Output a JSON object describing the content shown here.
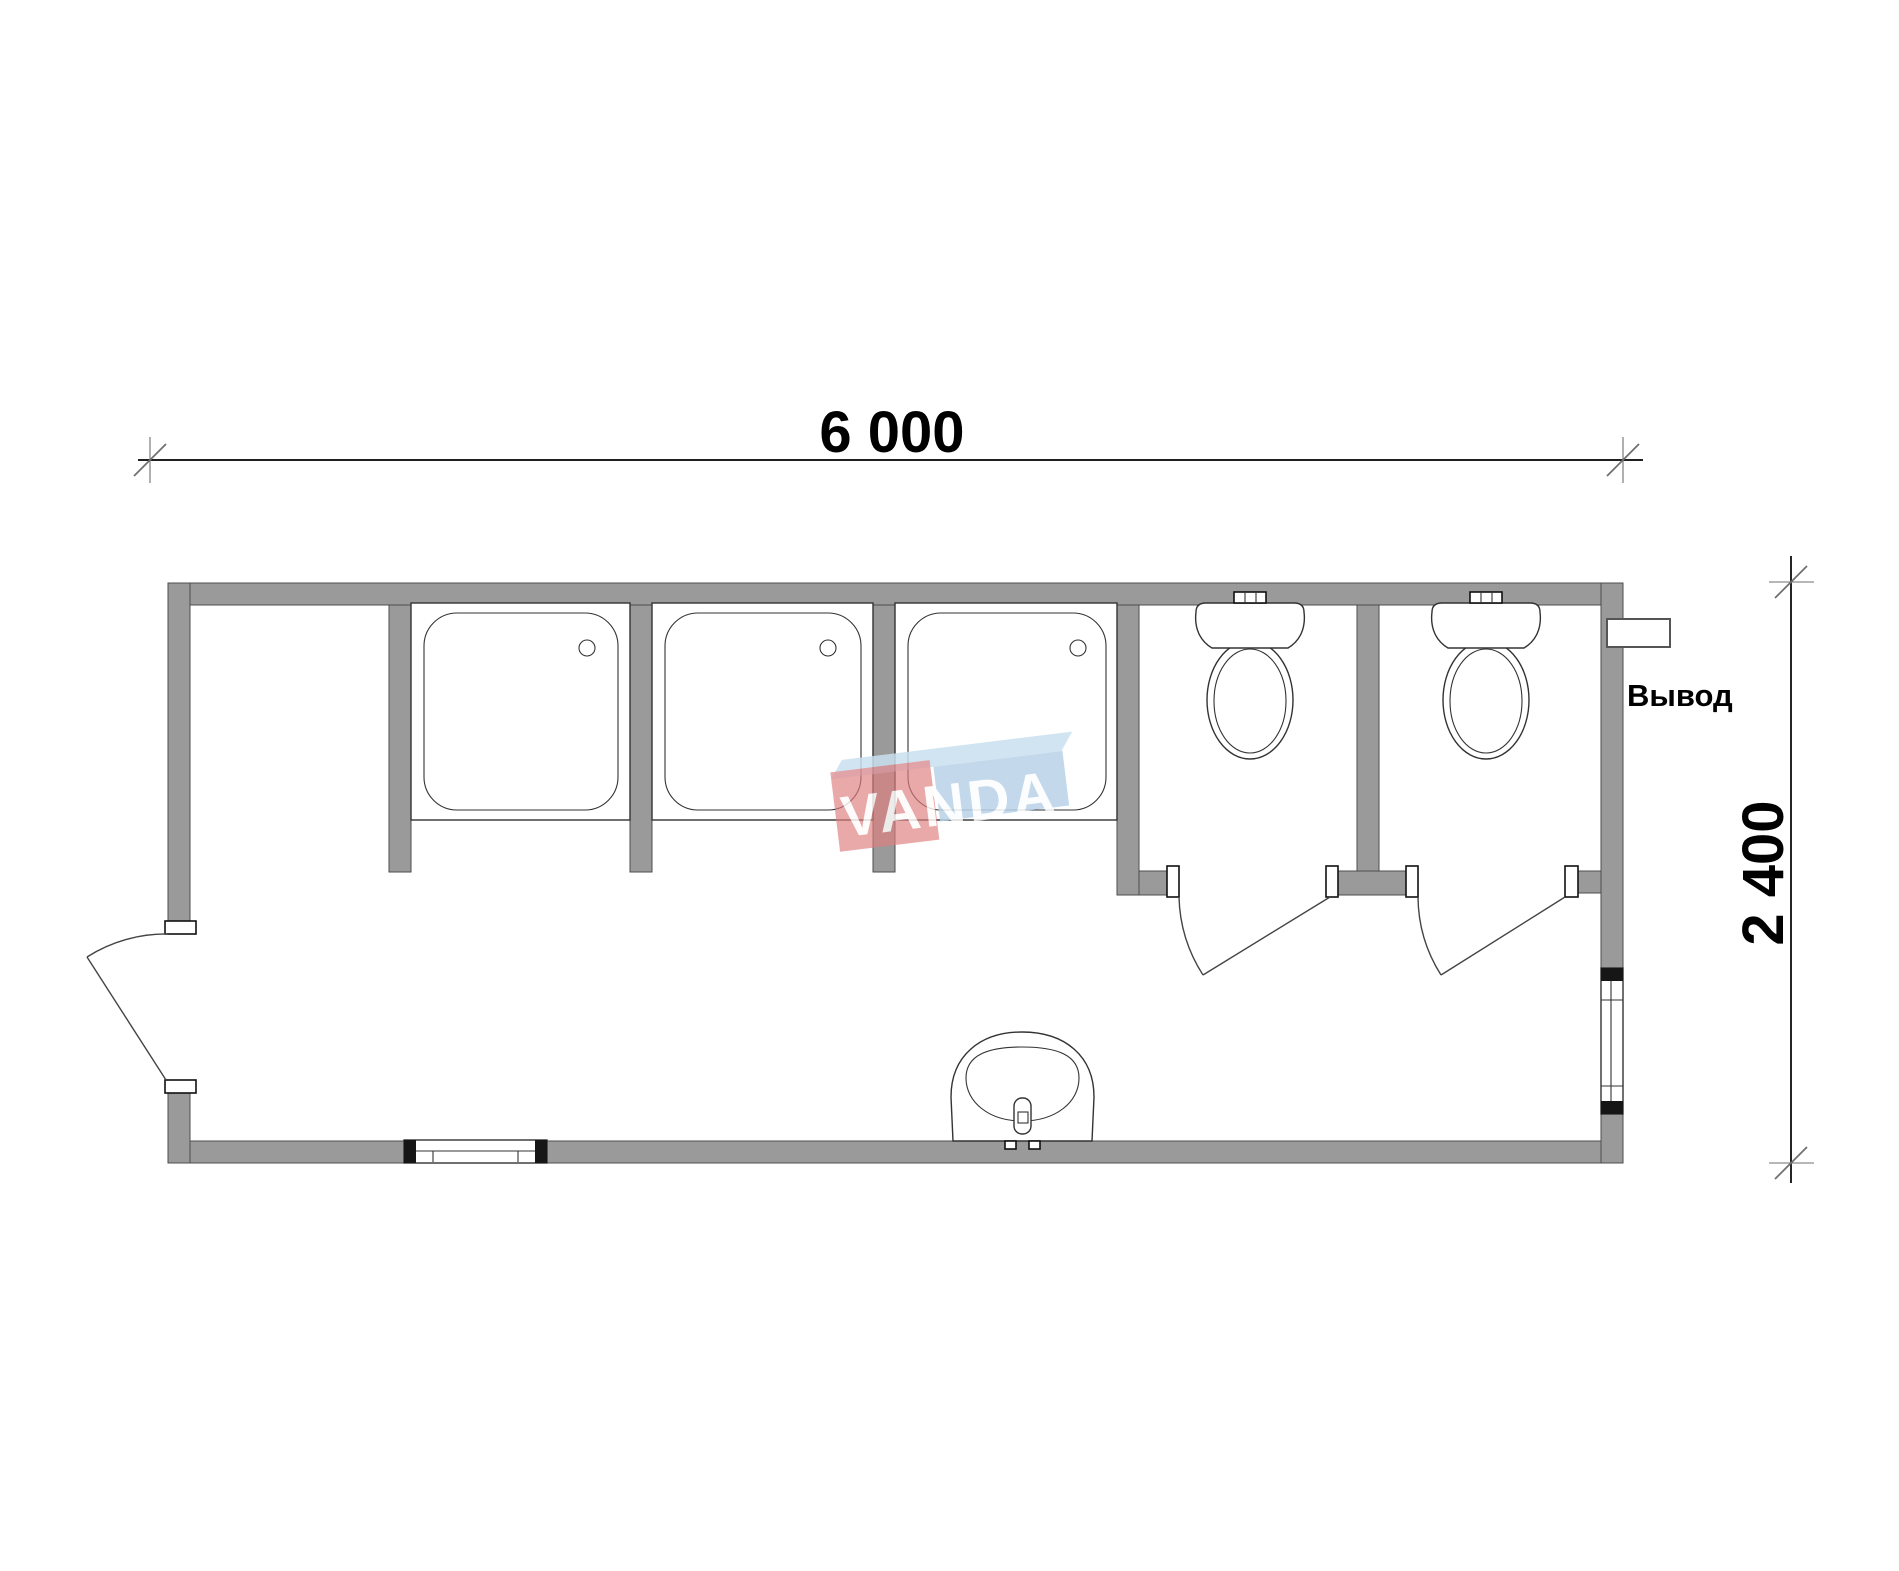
{
  "document": {
    "kind": "floor-plan-drawing"
  },
  "dimensions": {
    "width_label": "6 000",
    "height_label": "2 400"
  },
  "annotations": {
    "outlet_label": "Вывод"
  },
  "watermark": {
    "text": "VANDA"
  },
  "fixtures": {
    "shower_trays": 3,
    "toilets": 2,
    "sinks": 1,
    "windows": 2,
    "doors": 3
  },
  "colors": {
    "wall": "#9a9a9a",
    "wall_edge": "#4d4d4d",
    "line": "#333333",
    "cap": "#161616",
    "dim": "#000000",
    "tick": "#6f6f6f",
    "logo_red": "#e07f7f",
    "logo_blue": "#b9d3e8",
    "logo_blue_top": "#c9e0ef"
  }
}
